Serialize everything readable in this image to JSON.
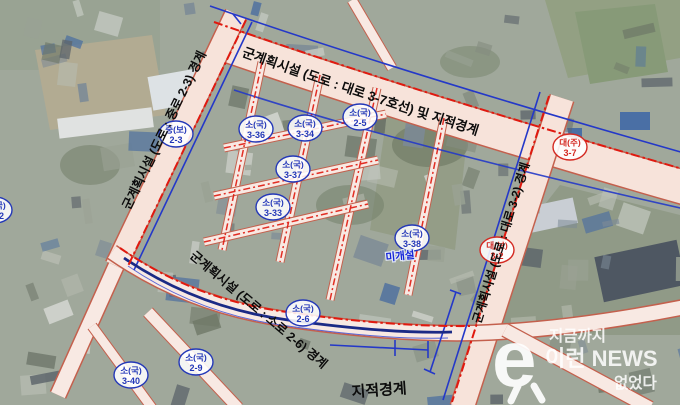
{
  "map": {
    "road_labels": {
      "top": "군계획시설 (도로 : 대로 3-7호선) 및 지적경계",
      "left": "군계획시설 (도로 : 중로 2-3) 경계",
      "right": "군계획시설 (도로 : 대로 3-2) 경계",
      "bottom": "군계획시설 (도로 : 소로 2-6) 경계",
      "cadastral_boundary": "지적경계",
      "unbuilt": "미개설"
    },
    "markers": [
      {
        "type": "소(국)",
        "code": "3-32",
        "color": "#2438b8"
      },
      {
        "type": "중(보)",
        "code": "2-3",
        "color": "#2438b8"
      },
      {
        "type": "소(국)",
        "code": "3-36",
        "color": "#2438b8"
      },
      {
        "type": "소(국)",
        "code": "3-34",
        "color": "#2438b8"
      },
      {
        "type": "소(국)",
        "code": "2-5",
        "color": "#2438b8"
      },
      {
        "type": "소(국)",
        "code": "3-37",
        "color": "#2438b8"
      },
      {
        "type": "소(국)",
        "code": "3-33",
        "color": "#2438b8"
      },
      {
        "type": "소(국)",
        "code": "3-38",
        "color": "#2438b8"
      },
      {
        "type": "대(주)",
        "code": "3-7",
        "color": "#d42a22"
      },
      {
        "type": "대(보)",
        "code": "3-2",
        "color": "#d42a22"
      },
      {
        "type": "소(국)",
        "code": "2-6",
        "color": "#2438b8"
      },
      {
        "type": "소(국)",
        "code": "2-9",
        "color": "#2438b8"
      },
      {
        "type": "소(국)",
        "code": "3-40",
        "color": "#2438b8"
      }
    ],
    "colors": {
      "boundary_red": "#e0190f",
      "dimension_blue": "#2438c8",
      "cadastral_navy": "#1b2a85",
      "road_fill": "#f7e3da"
    }
  },
  "watermark": {
    "logo": "e",
    "line1": "지금까지",
    "line2": "이런 NEWS",
    "line3": "없었다"
  }
}
